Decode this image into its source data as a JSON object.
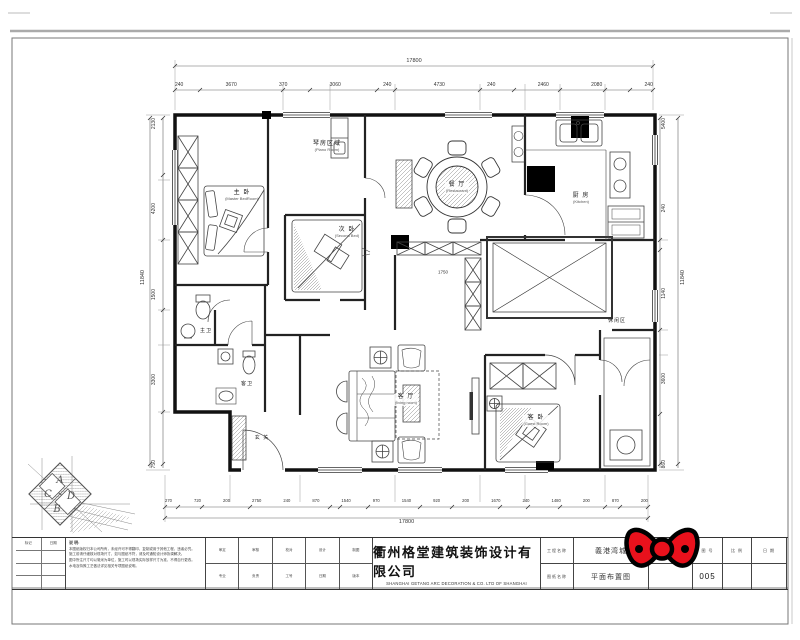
{
  "sheet": {
    "company": {
      "name_cn": "衢州格堂建筑装饰设计有限公司",
      "name_en": "SHANGHAI GETANG ARC DECORATION  &   CO. LTD OF SHANGHAI"
    },
    "title_block": {
      "project_label": "工程名称",
      "project_value": "義港湾城",
      "drawing_label": "图纸名称",
      "drawing_value": "平面布置图",
      "design_no_label": "设计号",
      "no_label": "图 号",
      "no_value": "005",
      "scale_label": "比 例",
      "date_label": "日 期",
      "mid_row1": [
        "审定",
        "审核",
        "校对",
        "设计",
        "制图"
      ],
      "mid_row2": [
        "专业",
        "负责",
        "工号",
        "日期",
        "版本"
      ],
      "left_table_h1": "标记",
      "left_table_h2": "日期",
      "notes_title": "说 明:",
      "notes_lines": [
        "本图纸版权归本公司所有，未经许可不得翻印、复制或用于其他工程，违者必究。",
        "施工前请仔细核对现场尺寸，如与图纸不符，请及时通知设计师协调解决。",
        "图中所注尺寸均以毫米为单位，施工时以现场实际放样尺寸为准，不得自行更改。",
        "水电及特殊工艺做法详见相关专项图纸说明。"
      ]
    }
  },
  "rooms": {
    "master": {
      "cn": "主 卧",
      "en": "(Master BedRoom)"
    },
    "piano": {
      "cn": "琴房区域",
      "en": "(Piano Room)"
    },
    "second": {
      "cn": "次 卧",
      "en": "(Second Bed)"
    },
    "dining": {
      "cn": "餐 厅",
      "en": "(Restaurant)"
    },
    "kitchen": {
      "cn": "厨 房",
      "en": "(Kitchen)"
    },
    "living": {
      "cn": "客 厅",
      "en": "(living room)"
    },
    "guest": {
      "cn": "客 卧",
      "en": "(Guest Room)"
    },
    "bath_master": {
      "cn": "主卫"
    },
    "bath_guest": {
      "cn": "客卫"
    },
    "entry": {
      "cn": "玄 关"
    },
    "leisure": {
      "cn": "休闲区"
    }
  },
  "dims": {
    "top_total": "17800",
    "top_segments": [
      "240",
      "3670",
      "370",
      "3060",
      "240",
      "4730",
      "240",
      "2460",
      "2080",
      "240"
    ],
    "bottom_segments": [
      "270",
      "720",
      "200",
      "2750",
      "240",
      "870",
      "1540",
      "970",
      "1540",
      "920",
      "200",
      "1670",
      "240",
      "1480",
      "200",
      "870",
      "200"
    ],
    "bottom_total": "17800",
    "left_segments": [
      "2130",
      "4200",
      "1500",
      "3300",
      "750"
    ],
    "left_total": "11840",
    "right_segments": [
      "5400",
      "240",
      "1140",
      "3600",
      "860"
    ],
    "right_total": "11840",
    "inner_hall": "1750"
  },
  "logo": {
    "letters": [
      "A",
      "C",
      "D",
      "B"
    ]
  },
  "colors": {
    "bow_red": "#e8111c",
    "line": "#222"
  }
}
